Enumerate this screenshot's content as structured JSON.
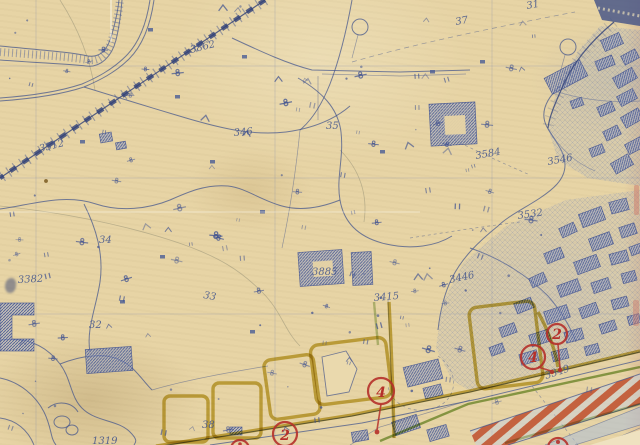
{
  "artifact_type": "scanned blueprint city map",
  "colors": {
    "paper": "#e7d4a5",
    "ink_blue": "#41538c",
    "ink_dark_blue": "#2f4078",
    "highlight_yellow": "#c2a92c",
    "highlight_green": "#6f9a32",
    "annotation_red": "#b5302a",
    "stripe_orange": "#c14f28",
    "road_wash_blue": "#a8bcdc"
  },
  "map_labels": [
    {
      "text": "3862"
    },
    {
      "text": "3512"
    },
    {
      "text": "37"
    },
    {
      "text": "35"
    },
    {
      "text": "346"
    },
    {
      "text": "3584"
    },
    {
      "text": "3546"
    },
    {
      "text": "3382"
    },
    {
      "text": "34"
    },
    {
      "text": "32"
    },
    {
      "text": "3885"
    },
    {
      "text": "3415"
    },
    {
      "text": "3446"
    },
    {
      "text": "3349"
    },
    {
      "text": "33"
    },
    {
      "text": "38"
    },
    {
      "text": "1319"
    },
    {
      "text": "31"
    },
    {
      "text": "3532"
    }
  ],
  "red_markers": [
    {
      "label": "4"
    },
    {
      "label": "4"
    },
    {
      "label": "2"
    },
    {
      "label": "2"
    }
  ]
}
